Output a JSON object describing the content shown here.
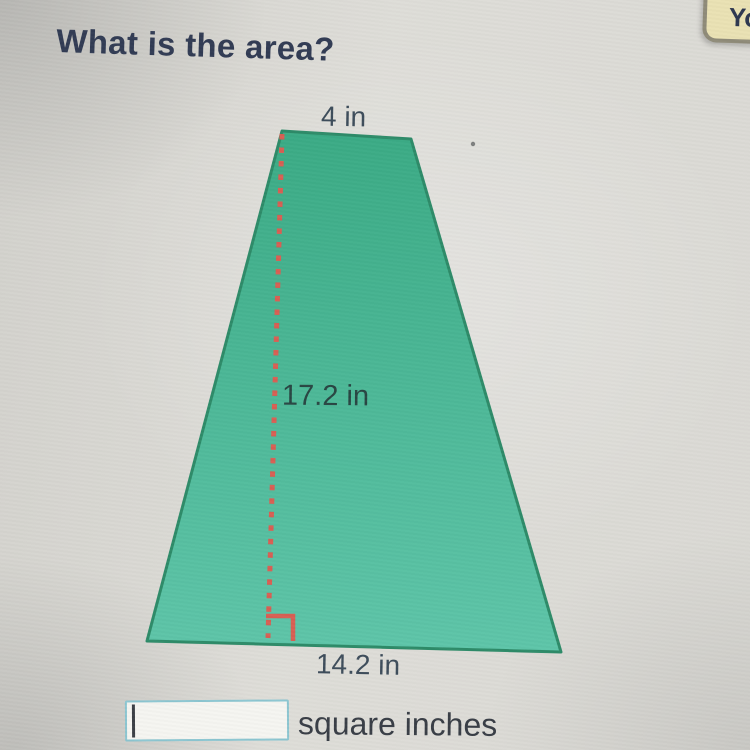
{
  "page": {
    "title": "What is the area?"
  },
  "corner_tab": {
    "label": "Yo"
  },
  "figure": {
    "shape": "trapezoid",
    "labels": {
      "top": "4 in",
      "height": "17.2 in",
      "base": "14.2 in"
    },
    "colors": {
      "fill_top": "#3bab85",
      "fill_bottom": "#5ec5a9",
      "border": "#2e8b69",
      "height_line": "#d85f53"
    }
  },
  "answer": {
    "value": "",
    "unit_label": "square inches"
  }
}
